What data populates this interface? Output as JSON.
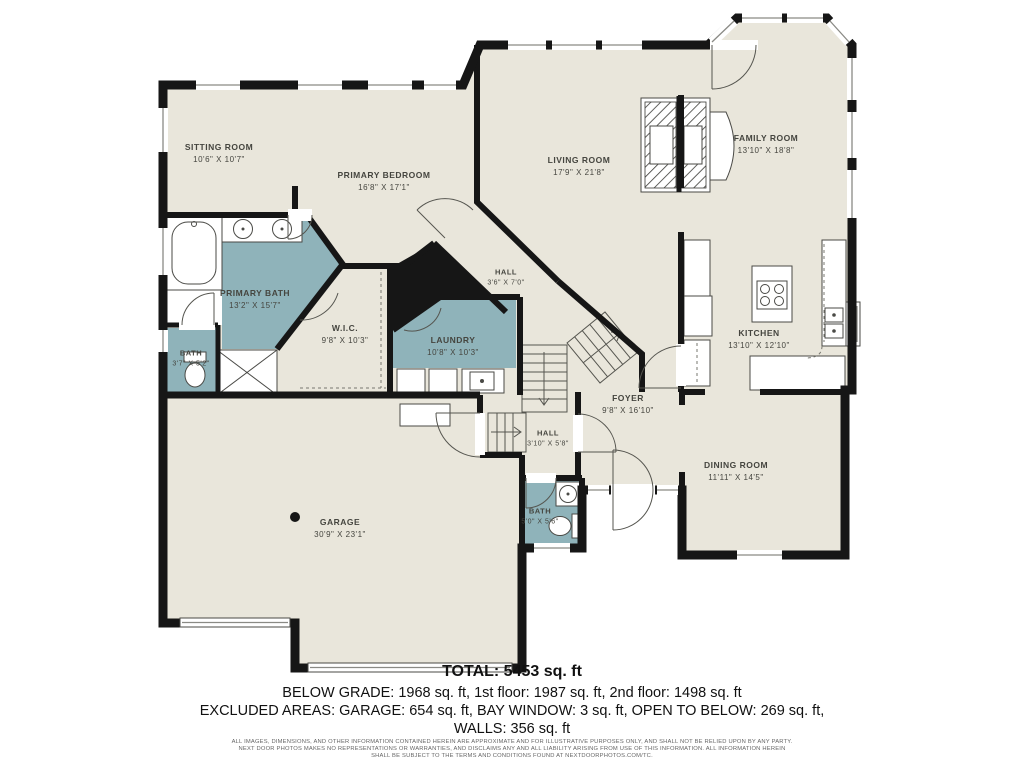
{
  "palette": {
    "wall": "#161616",
    "room_fill": "#e9e6db",
    "wet_fill": "#8fb3ba",
    "label_color": "#45453f"
  },
  "rooms": {
    "sitting_room": {
      "name": "SITTING ROOM",
      "dims": "10'6\" X 10'7\""
    },
    "primary_bedroom": {
      "name": "PRIMARY BEDROOM",
      "dims": "16'8\" X 17'1\""
    },
    "living_room": {
      "name": "LIVING ROOM",
      "dims": "17'9\" X 21'8\""
    },
    "family_room": {
      "name": "FAMILY ROOM",
      "dims": "13'10\" X 18'8\""
    },
    "hall_upper": {
      "name": "HALL",
      "dims": "3'6\" X 7'0\""
    },
    "primary_bath": {
      "name": "PRIMARY BATH",
      "dims": "13'2\" X 15'7\""
    },
    "bath_left": {
      "name": "BATH",
      "dims": "3'7\" X 5'2\""
    },
    "wic": {
      "name": "W.I.C.",
      "dims": "9'8\" X 10'3\""
    },
    "laundry": {
      "name": "LAUNDRY",
      "dims": "10'8\" X 10'3\""
    },
    "kitchen": {
      "name": "KITCHEN",
      "dims": "13'10\" X 12'10\""
    },
    "foyer": {
      "name": "FOYER",
      "dims": "9'8\" X 16'10\""
    },
    "hall_lower": {
      "name": "HALL",
      "dims": "3'10\" X 5'8\""
    },
    "bath_hall": {
      "name": "BATH",
      "dims": "5'0\" X 5'6\""
    },
    "dining_room": {
      "name": "DINING ROOM",
      "dims": "11'11\" X 14'5\""
    },
    "garage": {
      "name": "GARAGE",
      "dims": "30'9\" X 23'1\""
    }
  },
  "summary": {
    "total": "TOTAL: 5453 sq. ft",
    "line2": "BELOW GRADE: 1968 sq. ft, 1st floor: 1987 sq. ft, 2nd floor: 1498 sq. ft",
    "line3": "EXCLUDED AREAS: GARAGE: 654 sq. ft, BAY WINDOW: 3 sq. ft, OPEN TO BELOW: 269 sq. ft,",
    "line4": "WALLS: 356 sq. ft"
  },
  "disclaimer": {
    "line1": "ALL IMAGES, DIMENSIONS, AND OTHER INFORMATION CONTAINED HEREIN ARE APPROXIMATE AND FOR ILLUSTRATIVE PURPOSES ONLY, AND SHALL NOT BE RELIED UPON BY ANY PARTY.",
    "line2": "NEXT DOOR PHOTOS MAKES NO REPRESENTATIONS OR WARRANTIES, AND DISCLAIMS ANY AND ALL LIABILITY ARISING FROM USE OF THIS INFORMATION. ALL INFORMATION HEREIN",
    "line3": "SHALL BE SUBJECT TO THE TERMS AND CONDITIONS FOUND AT NEXTDOORPHOTOS.COM/TC."
  }
}
